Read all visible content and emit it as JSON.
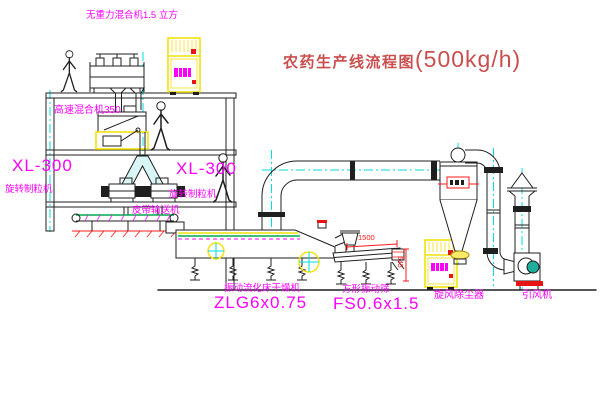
{
  "title": {
    "cn": "农药生产线流程图",
    "capacity": "(500kg/h)"
  },
  "labels": {
    "top_mixer": "无重力混合机1.5 立方",
    "high_speed_mixer": "高速混合机350",
    "granulator_left_model": "XL-300",
    "granulator_left_name": "旋转制粒机",
    "granulator_mid_model": "XL-300",
    "granulator_mid_name": "旋转制粒机",
    "belt_conveyor": "皮带输送机",
    "dryer_name": "振动流化床干燥机",
    "dryer_model": "ZLG6x0.75",
    "sieve_name": "方形振动筛",
    "sieve_model": "FS0.6x1.5",
    "dust_collector": "旋风除尘器",
    "induced_fan": "引风机"
  },
  "dimensions": {
    "sieve_length": "1500",
    "sieve_height": "545"
  },
  "colors": {
    "magenta": "#ff00ff",
    "title-red": "#c94f4f",
    "dim-red": "#ff1a1a",
    "base-red": "#e81414",
    "line": "#1f1f1f",
    "yellow": "#f2e20a",
    "cyan": "#00dede",
    "green": "#00a84f",
    "motor-teal": "#1fae9e",
    "splitter-fill": "#d8f6f6"
  }
}
